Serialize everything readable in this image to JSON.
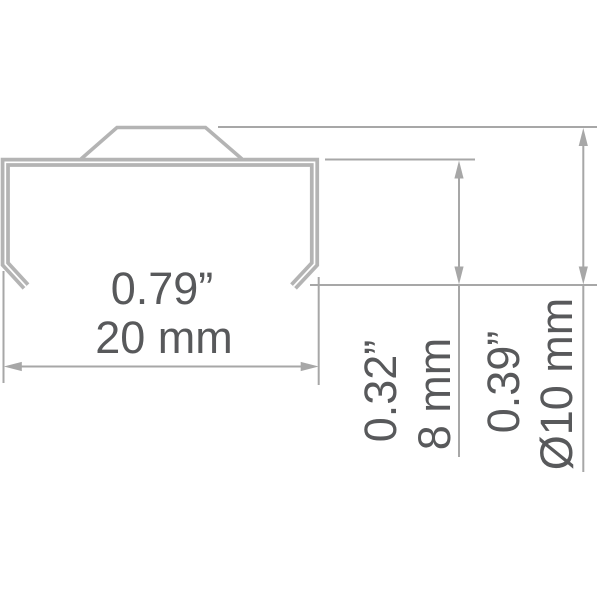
{
  "drawing": {
    "labels": {
      "width_in": "0.79”",
      "width_mm": "20 mm",
      "inner_height_in": "0.32”",
      "inner_height_mm": "8 mm",
      "outer_height_in": "0.39”",
      "outer_height_mm": "Ø10 mm"
    },
    "colors": {
      "background": "#ffffff",
      "profile_stroke": "#b4b4b4",
      "dimension_stroke": "#a7a7a7",
      "text": "#58595b"
    }
  }
}
